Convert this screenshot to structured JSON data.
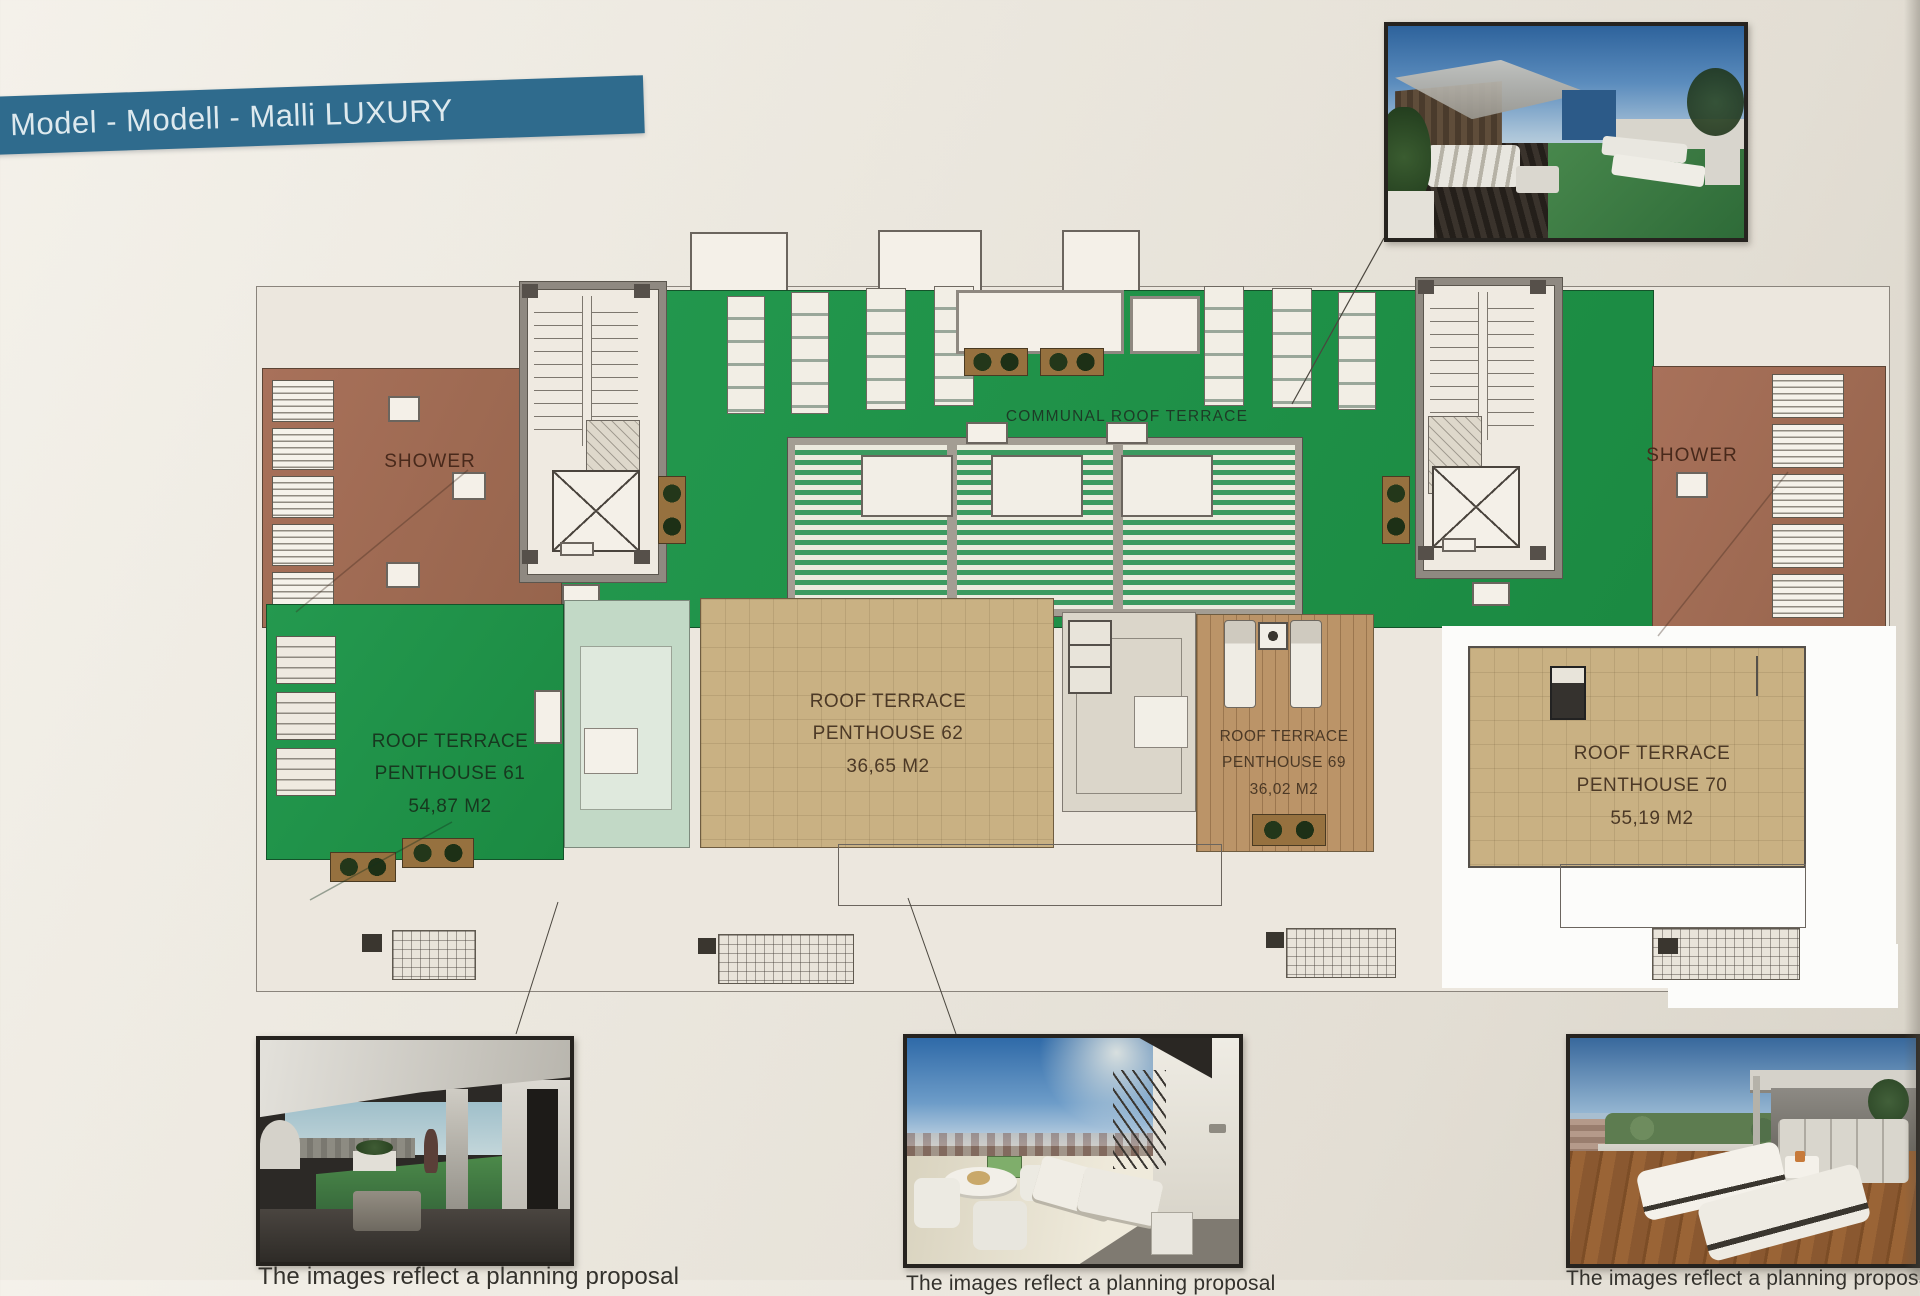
{
  "banner": {
    "title": "Model - Modell - Malli LUXURY"
  },
  "plan": {
    "communal_label": "COMMUNAL ROOF TERRACE",
    "shower_left_label": "SHOWER",
    "shower_right_label": "SHOWER",
    "penthouses": [
      {
        "name": "ROOF TERRACE",
        "unit": "PENTHOUSE 61",
        "area": "54,87 M2"
      },
      {
        "name": "ROOF TERRACE",
        "unit": "PENTHOUSE 62",
        "area": "36,65 M2"
      },
      {
        "name": "ROOF TERRACE",
        "unit": "PENTHOUSE 69",
        "area": "36,02 M2"
      },
      {
        "name": "ROOF TERRACE",
        "unit": "PENTHOUSE 70",
        "area": "55,19 M2"
      }
    ]
  },
  "captions": {
    "bottom_left": "The images reflect a planning proposal",
    "bottom_middle": "The images reflect a planning proposal",
    "bottom_right": "The images reflect a planning proposal"
  },
  "colors": {
    "banner_blue": "#2f6b8d",
    "communal_green": "#1d9148",
    "terrace_tile_beige": "#c9b183",
    "communal_deck_terracotta": "#a06b52",
    "wood_deck_brown": "#bb9468",
    "pale_green_terrace": "#c2d9c6",
    "highlight_frame_white": "#fcfcfa",
    "paper_background": "#e9e5dc"
  }
}
